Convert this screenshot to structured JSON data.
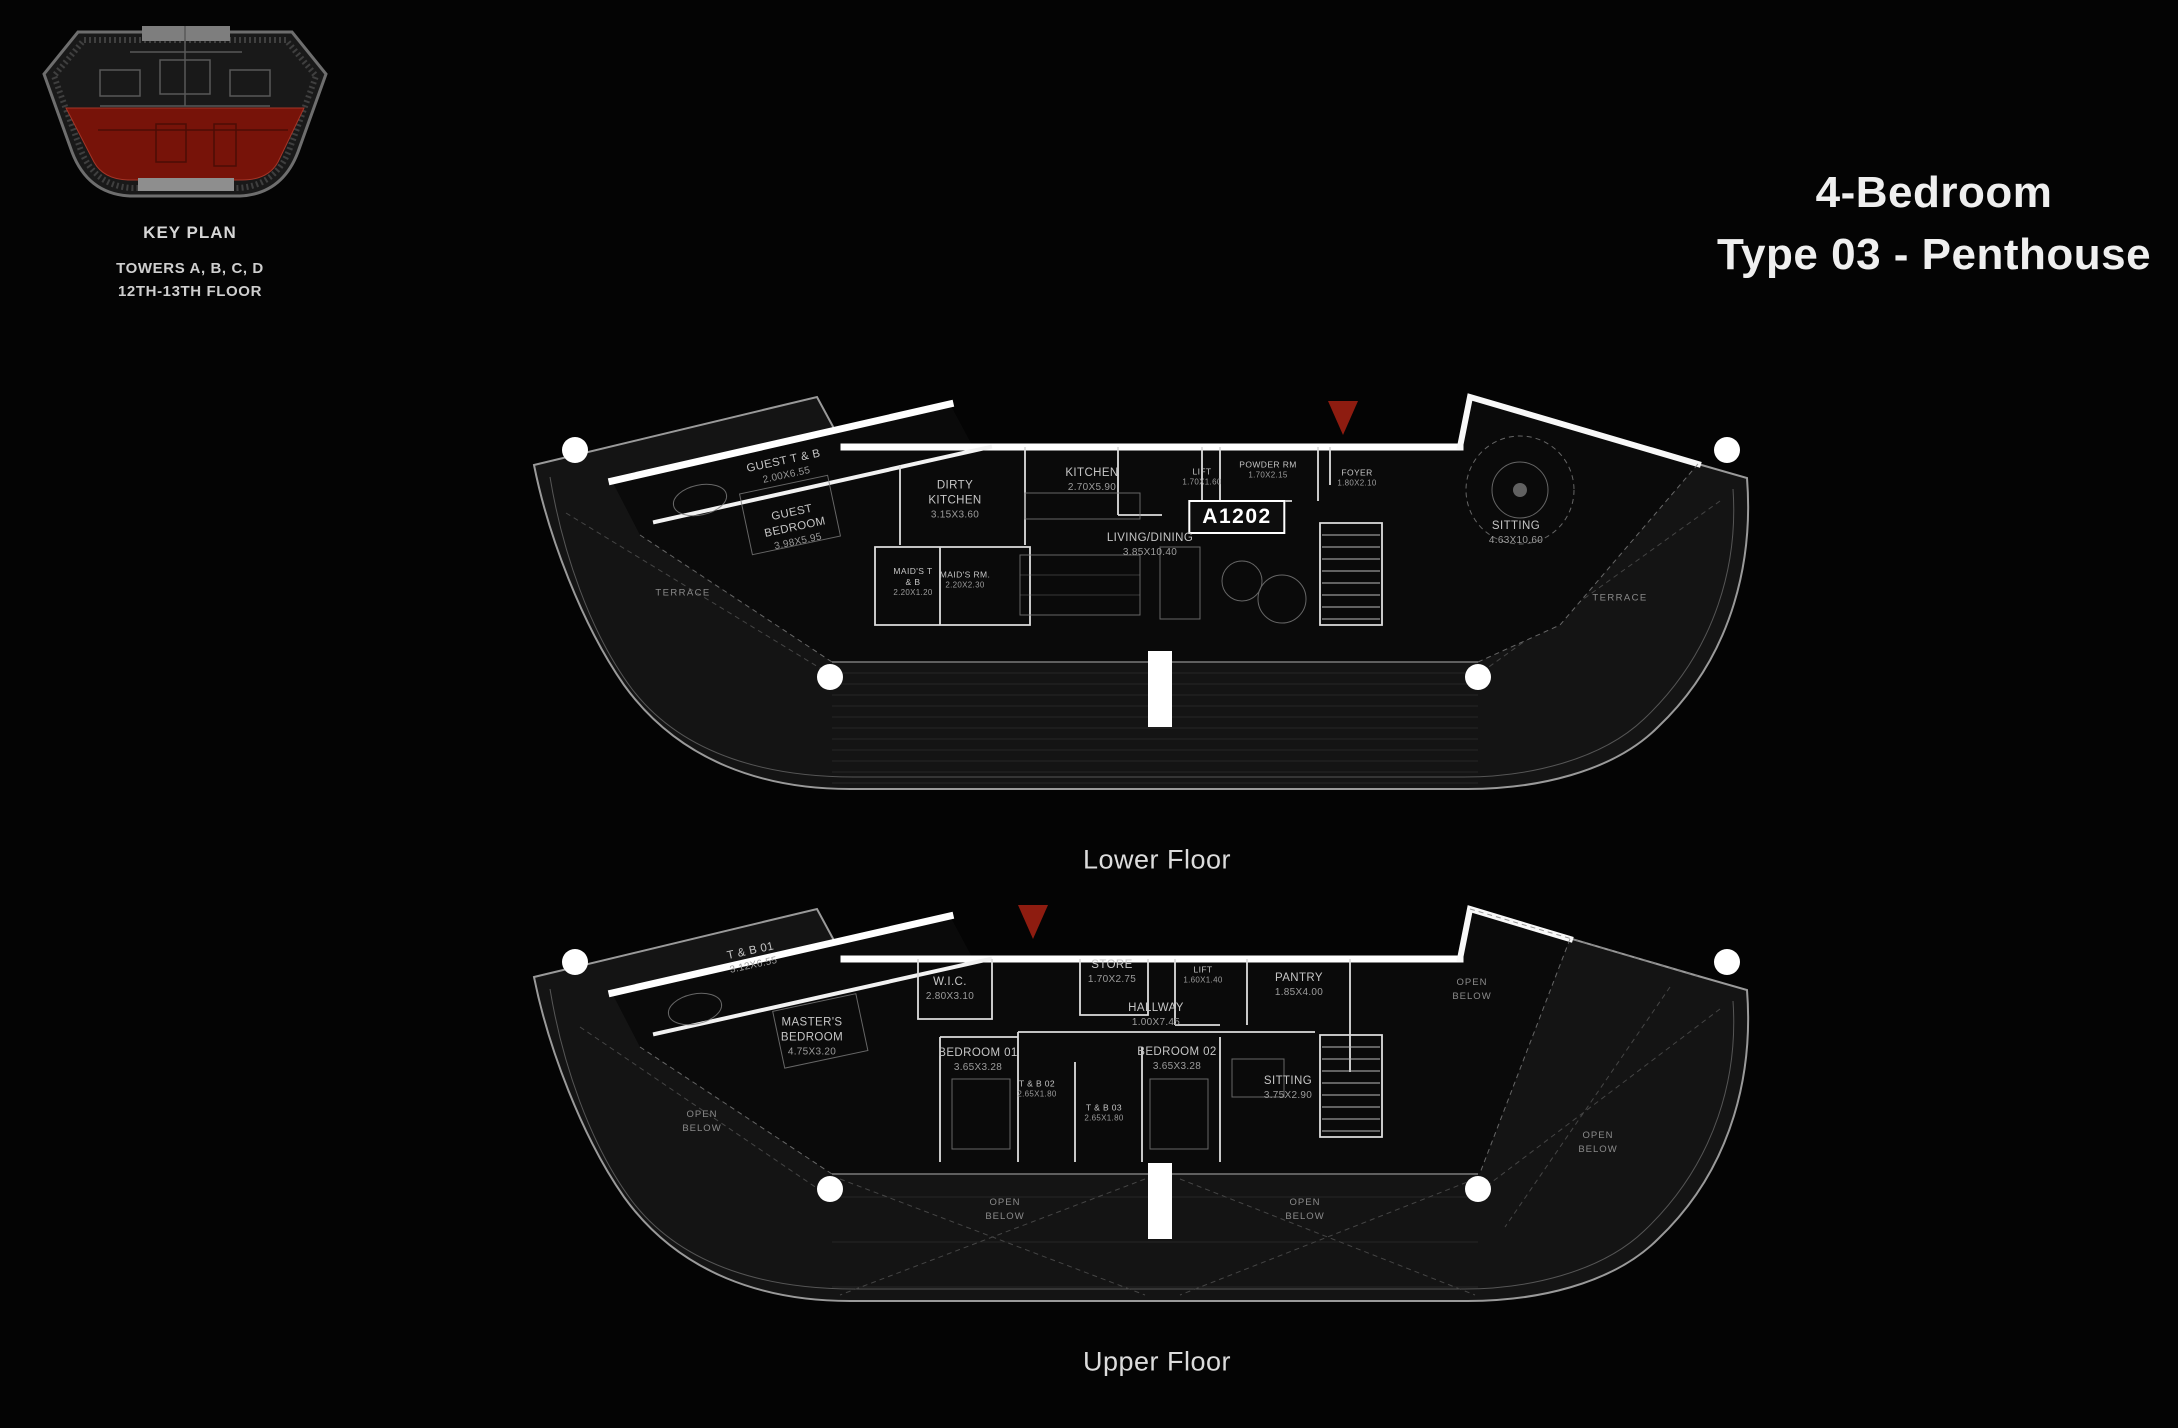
{
  "key_plan": {
    "caption": "KEY PLAN",
    "towers": "TOWERS A, B, C, D",
    "floors": "12TH-13TH FLOOR"
  },
  "title": {
    "line1": "4-Bedroom",
    "line2": "Type 03 - Penthouse"
  },
  "unit_number": "A1202",
  "colors": {
    "highlight_red": "#8e1c10",
    "wall_white": "#ffffff",
    "background": "#040404"
  },
  "lower_floor": {
    "caption": "Lower Floor",
    "rooms": {
      "guest_tb": {
        "name": "GUEST T & B",
        "dims": "2.00X6.55"
      },
      "guest_bedroom": {
        "name": "GUEST BEDROOM",
        "dims": "3.98X5.95"
      },
      "dirty_kitchen": {
        "name": "DIRTY KITCHEN",
        "dims": "3.15X3.60"
      },
      "maids_tb": {
        "name": "MAID'S T & B",
        "dims": "2.20X1.20"
      },
      "maids_rm": {
        "name": "MAID'S RM.",
        "dims": "2.20X2.30"
      },
      "kitchen": {
        "name": "KITCHEN",
        "dims": "2.70X5.90"
      },
      "living_dining": {
        "name": "LIVING/DINING",
        "dims": "3.85X10.40"
      },
      "lift": {
        "name": "LIFT",
        "dims": "1.70X1.60"
      },
      "powder_rm": {
        "name": "POWDER RM",
        "dims": "1.70X2.15"
      },
      "foyer": {
        "name": "FOYER",
        "dims": "1.80X2.10"
      },
      "sitting": {
        "name": "SITTING",
        "dims": "4.63X10.60"
      },
      "terrace_left": {
        "name": "TERRACE"
      },
      "terrace_right": {
        "name": "TERRACE"
      }
    }
  },
  "upper_floor": {
    "caption": "Upper Floor",
    "rooms": {
      "tb01": {
        "name": "T & B 01",
        "dims": "3.12X6.55"
      },
      "wic": {
        "name": "W.I.C.",
        "dims": "2.80X3.10"
      },
      "masters_bedroom": {
        "name": "MASTER'S BEDROOM",
        "dims": "4.75X3.20"
      },
      "store": {
        "name": "STORE",
        "dims": "1.70X2.75"
      },
      "lift": {
        "name": "LIFT",
        "dims": "1.60X1.40"
      },
      "pantry": {
        "name": "PANTRY",
        "dims": "1.85X4.00"
      },
      "hallway": {
        "name": "HALLWAY",
        "dims": "1.00X7.45"
      },
      "bedroom01": {
        "name": "BEDROOM 01",
        "dims": "3.65X3.28"
      },
      "bedroom02": {
        "name": "BEDROOM 02",
        "dims": "3.65X3.28"
      },
      "tb02": {
        "name": "T & B 02",
        "dims": "2.65X1.80"
      },
      "tb03": {
        "name": "T & B 03",
        "dims": "2.65X1.80"
      },
      "sitting": {
        "name": "SITTING",
        "dims": "3.75X2.90"
      },
      "open_below_left": {
        "name": "OPEN BELOW"
      },
      "open_below_top_right": {
        "name": "OPEN BELOW"
      },
      "open_below_right": {
        "name": "OPEN BELOW"
      },
      "open_below_bottom_left": {
        "name": "OPEN BELOW"
      },
      "open_below_bottom_right": {
        "name": "OPEN BELOW"
      }
    }
  }
}
